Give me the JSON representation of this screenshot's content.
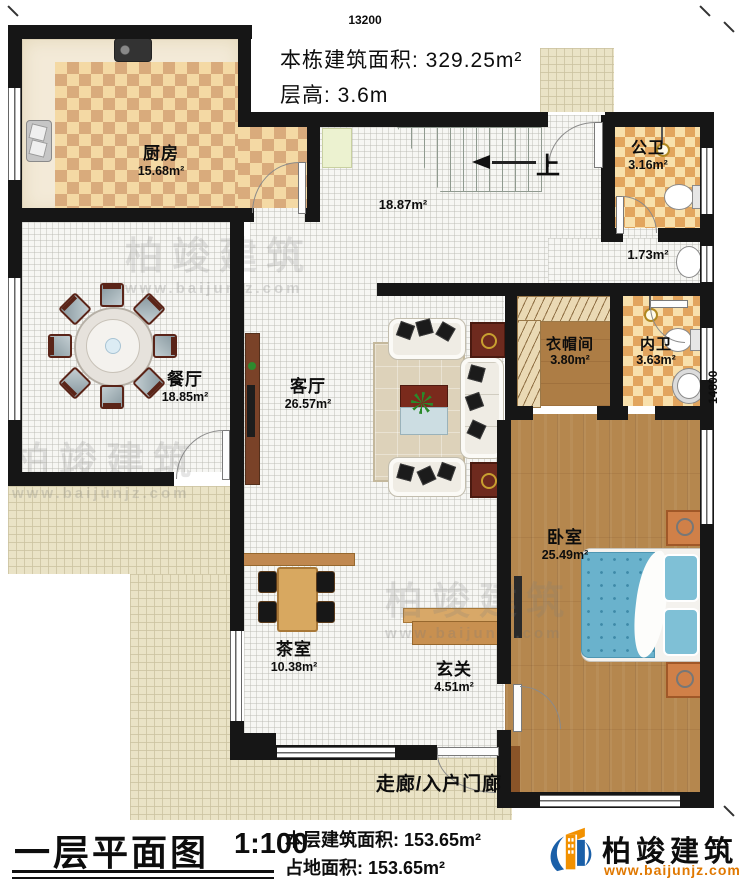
{
  "top_info": {
    "building_area": "本栋建筑面积: 329.25m²",
    "floor_height": "层高: 3.6m"
  },
  "dimensions": {
    "width": "13200",
    "height": "14800"
  },
  "rooms": [
    {
      "id": "kitchen",
      "name": "厨房",
      "area": "15.68m²"
    },
    {
      "id": "dining",
      "name": "餐厅",
      "area": "18.85m²"
    },
    {
      "id": "living",
      "name": "客厅",
      "area": "26.57m²"
    },
    {
      "id": "hall",
      "name": "",
      "area": "18.87m²"
    },
    {
      "id": "public-bath",
      "name": "公卫",
      "area": "3.16m²"
    },
    {
      "id": "vestibule",
      "name": "",
      "area": "1.73m²"
    },
    {
      "id": "cloakroom",
      "name": "衣帽间",
      "area": "3.80m²"
    },
    {
      "id": "private-bath",
      "name": "内卫",
      "area": "3.63m²"
    },
    {
      "id": "bedroom",
      "name": "卧室",
      "area": "25.49m²"
    },
    {
      "id": "tea-room",
      "name": "茶室",
      "area": "10.38m²"
    },
    {
      "id": "entry",
      "name": "玄关",
      "area": "4.51m²"
    },
    {
      "id": "corridor",
      "name": "走廊/入户门廊",
      "area": ""
    }
  ],
  "stairs": {
    "up_label": "上"
  },
  "title_block": {
    "title": "一层平面图",
    "scale": "1:100",
    "floor_area": "本层建筑面积: 153.65m²",
    "footprint": "占地面积: 153.65m²"
  },
  "brand": {
    "name": "柏竣建筑",
    "website": "www.baijunjz.com"
  },
  "colors": {
    "wall": "#161616",
    "brand_blue": "#1a5fa8",
    "brand_orange": "#f29100",
    "bed_blue": "#6ab2cc",
    "wood": "#b5874e",
    "checker_warm": "#d9ab7c",
    "patio": "#eae3c6"
  }
}
